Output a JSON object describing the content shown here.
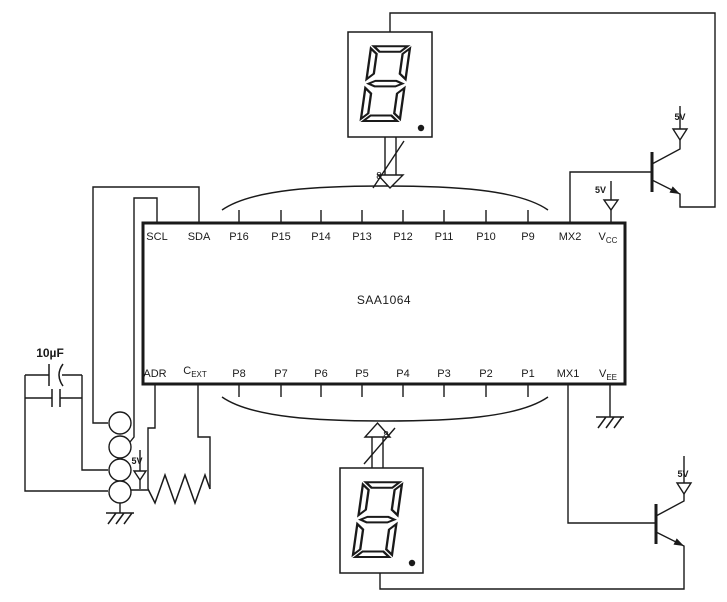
{
  "diagram": {
    "type": "circuit-schematic",
    "ic": {
      "name": "SAA1064",
      "top_pins": [
        "SCL",
        "SDA",
        "P16",
        "P15",
        "P14",
        "P13",
        "P12",
        "P11",
        "P10",
        "P9",
        "MX2",
        "V_CC"
      ],
      "bottom_pins": [
        "ADR",
        "C_EXT",
        "P8",
        "P7",
        "P6",
        "P5",
        "P4",
        "P3",
        "P2",
        "P1",
        "MX1",
        "V_EE"
      ]
    },
    "labels": {
      "capacitor_value": "10µF",
      "supply_voltage": "5V",
      "bus_width": "8"
    },
    "displays": {
      "count": 2,
      "type": "seven-segment",
      "digit": "8",
      "decimal_point": true
    },
    "transistors": {
      "count": 2,
      "type": "NPN emitter-follower"
    },
    "connector_terminals": 4,
    "colors": {
      "line": "#1a1a1a",
      "background": "#ffffff"
    }
  }
}
